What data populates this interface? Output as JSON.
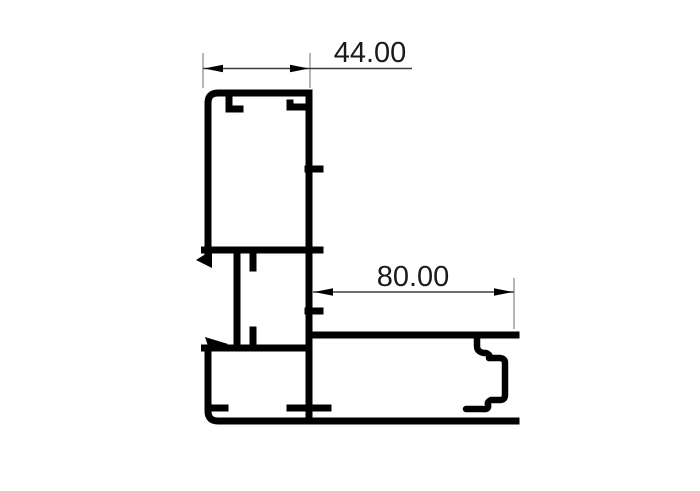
{
  "drawing": {
    "background_color": "#ffffff",
    "profile_color": "#000000",
    "dimension_line_color": "#3d3d3d",
    "extension_line_color": "#8f8f8f",
    "arrow_color": "#000000",
    "text_color": "#1a1a1a",
    "dimensions": {
      "top_width": {
        "value": "44.00"
      },
      "bottom_width": {
        "value": "80.00"
      }
    }
  }
}
